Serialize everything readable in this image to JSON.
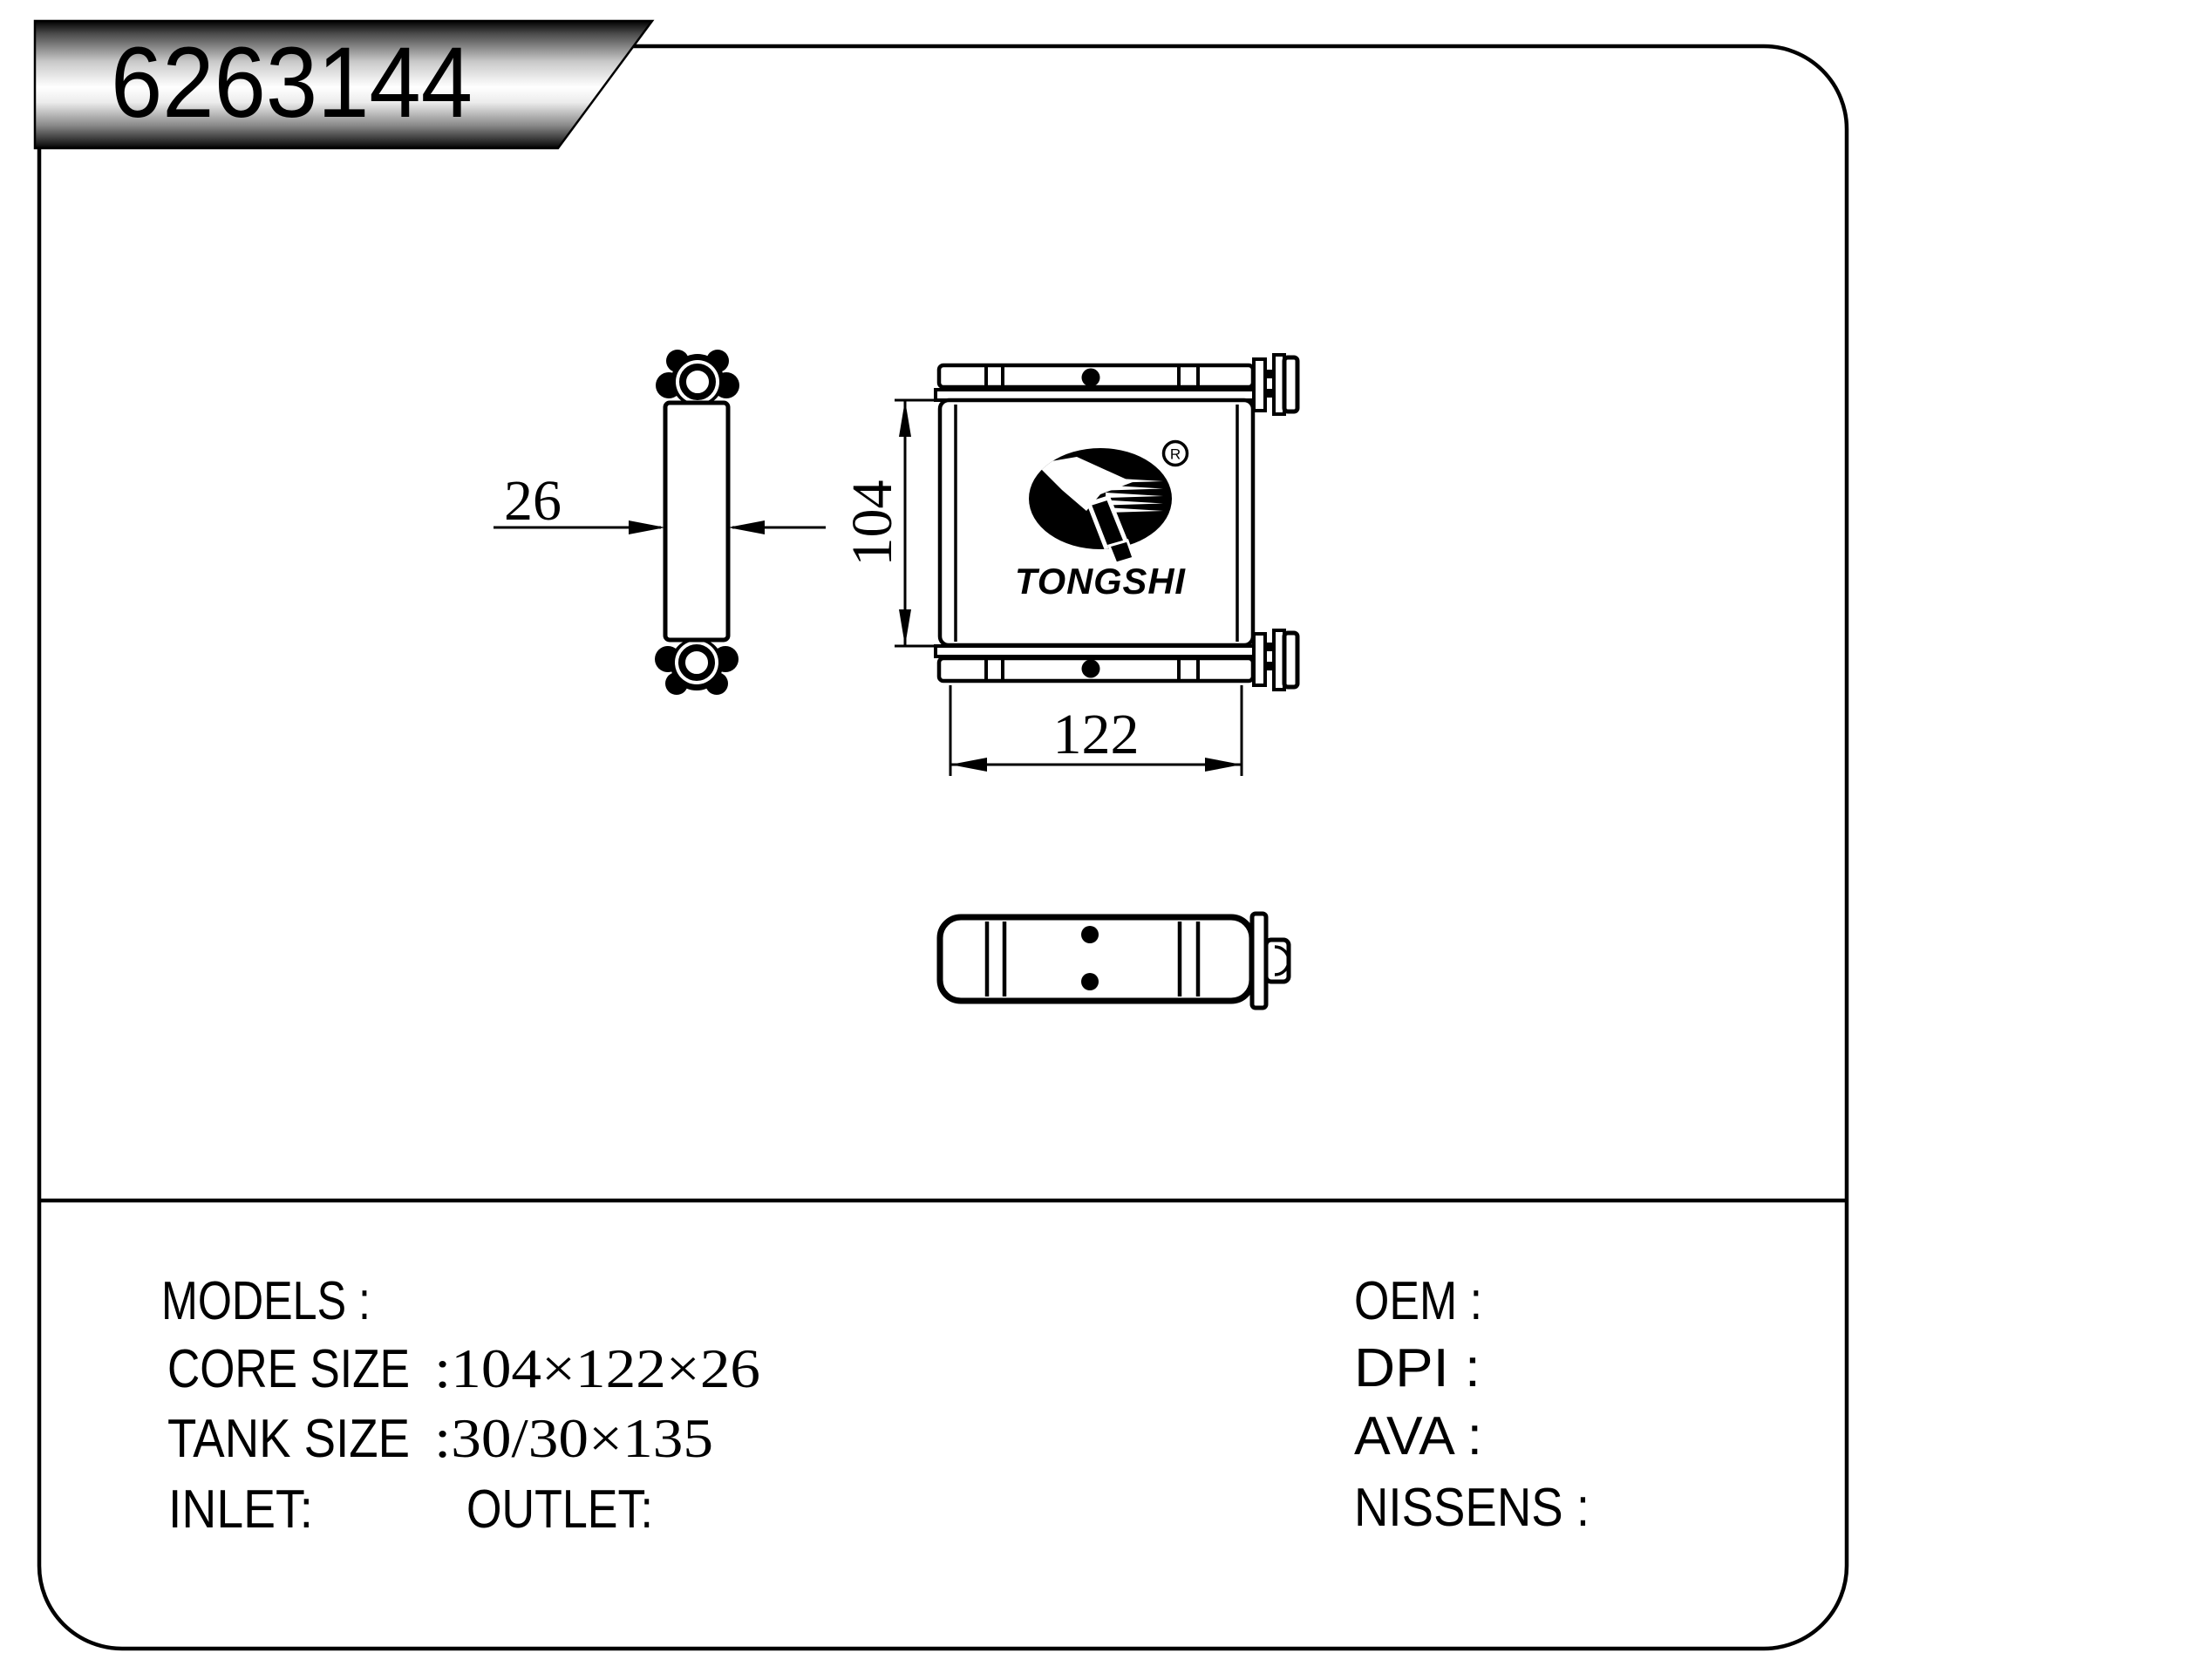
{
  "title_banner": {
    "part_number": "6263144"
  },
  "drawing": {
    "dim_depth": "26",
    "dim_height": "104",
    "dim_width": "122",
    "brand": "TONGSHI",
    "registered_mark": "R"
  },
  "specs": {
    "models_label": "MODELS :",
    "core_size_label": "CORE SIZE",
    "core_size_value": ":104×122×26",
    "tank_size_label": "TANK SIZE",
    "tank_size_value": ":30/30×135",
    "inlet_label": "INLET:",
    "outlet_label": "OUTLET:",
    "oem_label": "OEM :",
    "dpi_label": "DPI :",
    "ava_label": "AVA :",
    "nissens_label": "NISSENS :"
  }
}
